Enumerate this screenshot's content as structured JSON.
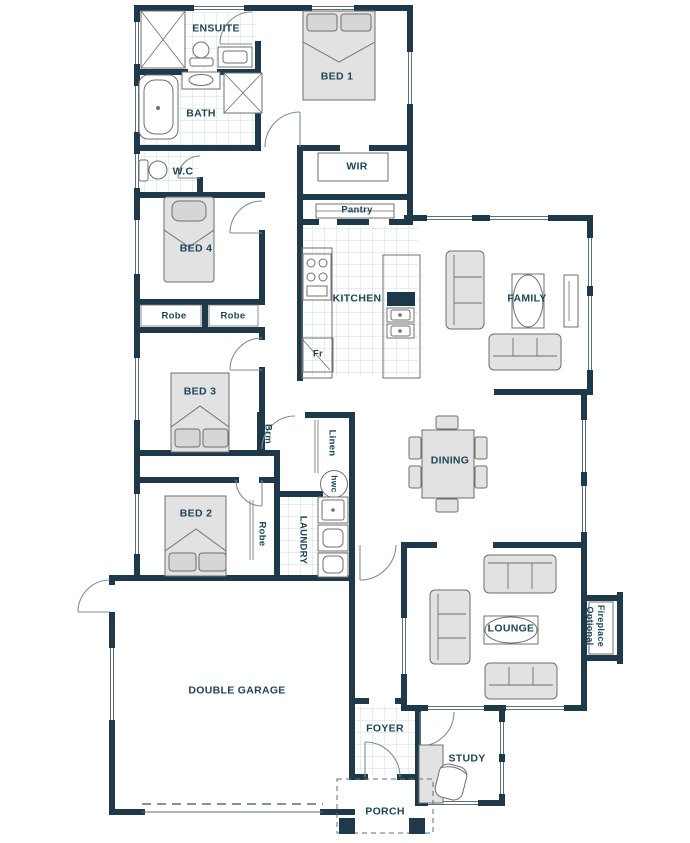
{
  "plan": {
    "title": "residential floor plan",
    "colors": {
      "wall": "#1e3a4a",
      "label": "#1d4557",
      "furniture_fill": "#e2e2e2",
      "thin_line": "#5d6f7b",
      "tile_line": "#ccd6dd",
      "background": "#ffffff"
    },
    "rooms": [
      {
        "id": "ensuite",
        "label": "ENSUITE"
      },
      {
        "id": "bed1",
        "label": "BED 1"
      },
      {
        "id": "bath",
        "label": "BATH"
      },
      {
        "id": "wc",
        "label": "W.C"
      },
      {
        "id": "wir",
        "label": "WIR"
      },
      {
        "id": "pantry",
        "label": "Pantry"
      },
      {
        "id": "bed4",
        "label": "BED 4"
      },
      {
        "id": "kitchen",
        "label": "KITCHEN"
      },
      {
        "id": "family",
        "label": "FAMILY"
      },
      {
        "id": "robe-bed4-left",
        "label": "Robe"
      },
      {
        "id": "robe-bed4-right",
        "label": "Robe"
      },
      {
        "id": "fridge",
        "label": "Fr"
      },
      {
        "id": "bed3",
        "label": "BED 3"
      },
      {
        "id": "broom",
        "label": "Brm"
      },
      {
        "id": "linen",
        "label": "Linen"
      },
      {
        "id": "dining",
        "label": "DINING"
      },
      {
        "id": "hwc",
        "label": "hwc"
      },
      {
        "id": "bed2",
        "label": "BED 2"
      },
      {
        "id": "robe-bed2",
        "label": "Robe"
      },
      {
        "id": "laundry",
        "label": "LAUNDRY"
      },
      {
        "id": "lounge",
        "label": "LOUNGE"
      },
      {
        "id": "fireplace",
        "label": "Fireplace Optional"
      },
      {
        "id": "garage",
        "label": "DOUBLE GARAGE"
      },
      {
        "id": "foyer",
        "label": "FOYER"
      },
      {
        "id": "study",
        "label": "STUDY"
      },
      {
        "id": "porch",
        "label": "PORCH"
      }
    ]
  }
}
